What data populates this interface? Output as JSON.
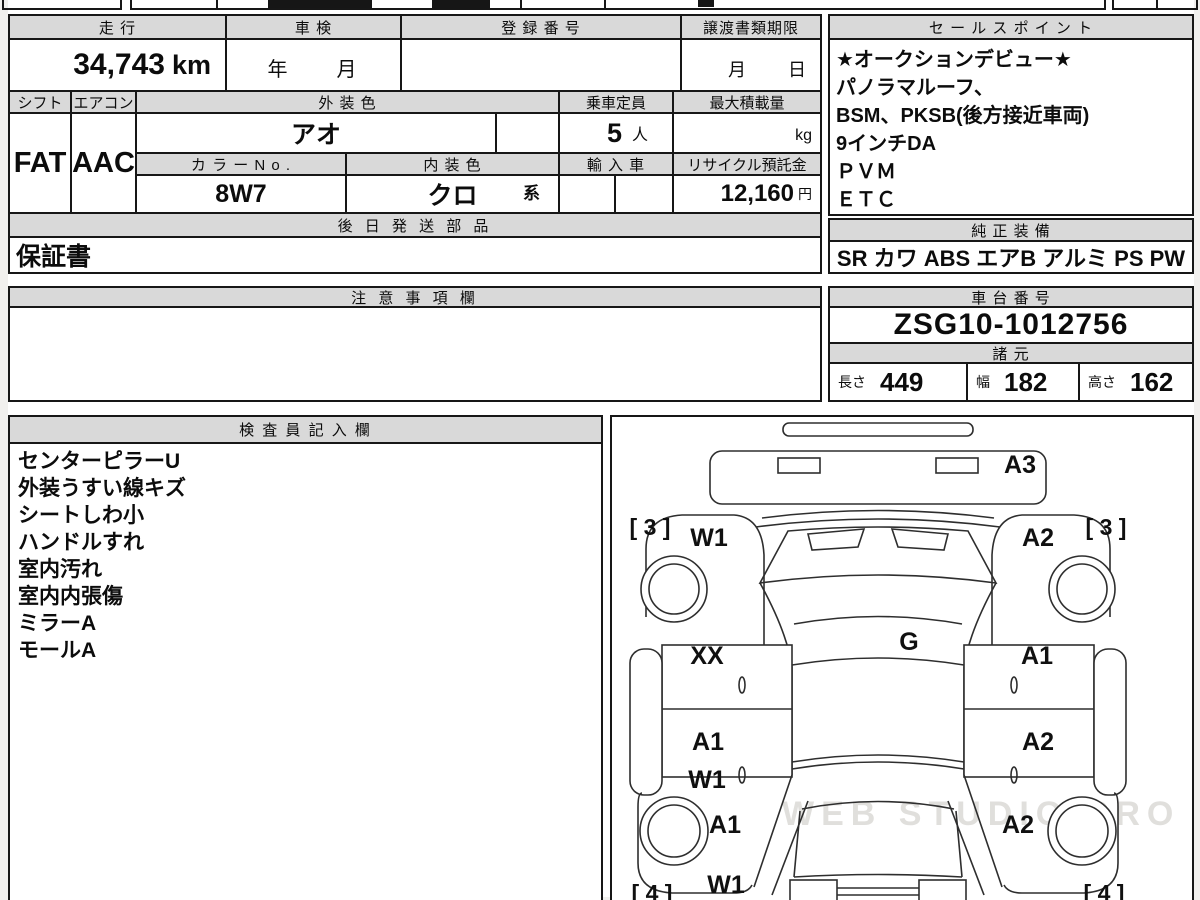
{
  "colors": {
    "header_bg": "#d9d9d9",
    "line": "#171717",
    "watermark_gray": "#a5a39b"
  },
  "info": {
    "mileage": {
      "label": "走 行",
      "value": "34,743",
      "unit": "km"
    },
    "inspection": {
      "label": "車 検",
      "value": "年　　月"
    },
    "registration": {
      "label": "登 録 番 号",
      "value": ""
    },
    "transfer": {
      "label": "譲渡書類期限",
      "value": "月　　日"
    },
    "shift": {
      "label": "シフト",
      "value": "FAT"
    },
    "aircon": {
      "label": "エアコン",
      "value": "AAC"
    },
    "exterior_color": {
      "label": "外 装 色",
      "value": "アオ"
    },
    "capacity": {
      "label": "乗車定員",
      "value": "5",
      "unit": "人"
    },
    "max_load": {
      "label": "最大積載量",
      "unit": "kg"
    },
    "color_no": {
      "label": "カ ラ ー N o .",
      "value": "8W7"
    },
    "interior_color": {
      "label": "内 装 色",
      "value": "クロ",
      "suffix": "系"
    },
    "import_car": {
      "label": "輸 入 車",
      "value": ""
    },
    "recycle": {
      "label": "リサイクル預託金",
      "value": "12,160",
      "unit": "円"
    },
    "later_parts": {
      "label": "後 日 発 送 部 品",
      "value": "保証書"
    },
    "notes": {
      "label": "注 意 事 項 欄",
      "value": ""
    }
  },
  "sales": {
    "title": "セ ー ル ス ポ イ ン ト",
    "lines": [
      "★オークションデビュー★",
      "パノラマルーフ、",
      "BSM、PKSB(後方接近車両)",
      "9インチDA",
      "ＰＶＭ",
      "ＥＴＣ"
    ]
  },
  "equipment": {
    "title": "純 正 装 備",
    "value": "SR カワ ABS エアB アルミ PS PW"
  },
  "chassis": {
    "title": "車 台 番 号",
    "value": "ZSG10-1012756"
  },
  "specs": {
    "title": "諸 元",
    "items": [
      {
        "label": "長さ",
        "value": "449"
      },
      {
        "label": "幅",
        "value": "182"
      },
      {
        "label": "高さ",
        "value": "162"
      }
    ]
  },
  "inspector": {
    "title": "検 査 員 記 入 欄",
    "lines": [
      "センターピラーU",
      "外装うすい線キズ",
      "シートしわ小",
      "ハンドルすれ",
      "室内汚れ",
      "室内内張傷",
      "ミラーA",
      "モールA"
    ]
  },
  "diagram": {
    "labels": {
      "front_panel": "A3",
      "front_left_grade": "[ 3 ]",
      "front_right_grade": "[ 3 ]",
      "front_left_fender": "W1",
      "front_right_fender": "A2",
      "front_left_door": "XX",
      "roof": "G",
      "front_right_door": "A1",
      "rear_left_door": "A1",
      "rear_right_door": "A2",
      "rear_left_door_w": "W1",
      "rear_left_quarter": "A1",
      "rear_right_quarter": "A2",
      "rear_left_quarter_w": "W1",
      "rear_left_grade": "[ 4 ]",
      "rear_right_grade": "[ 4 ]"
    },
    "watermark": "WEB STUDIO PRO"
  }
}
